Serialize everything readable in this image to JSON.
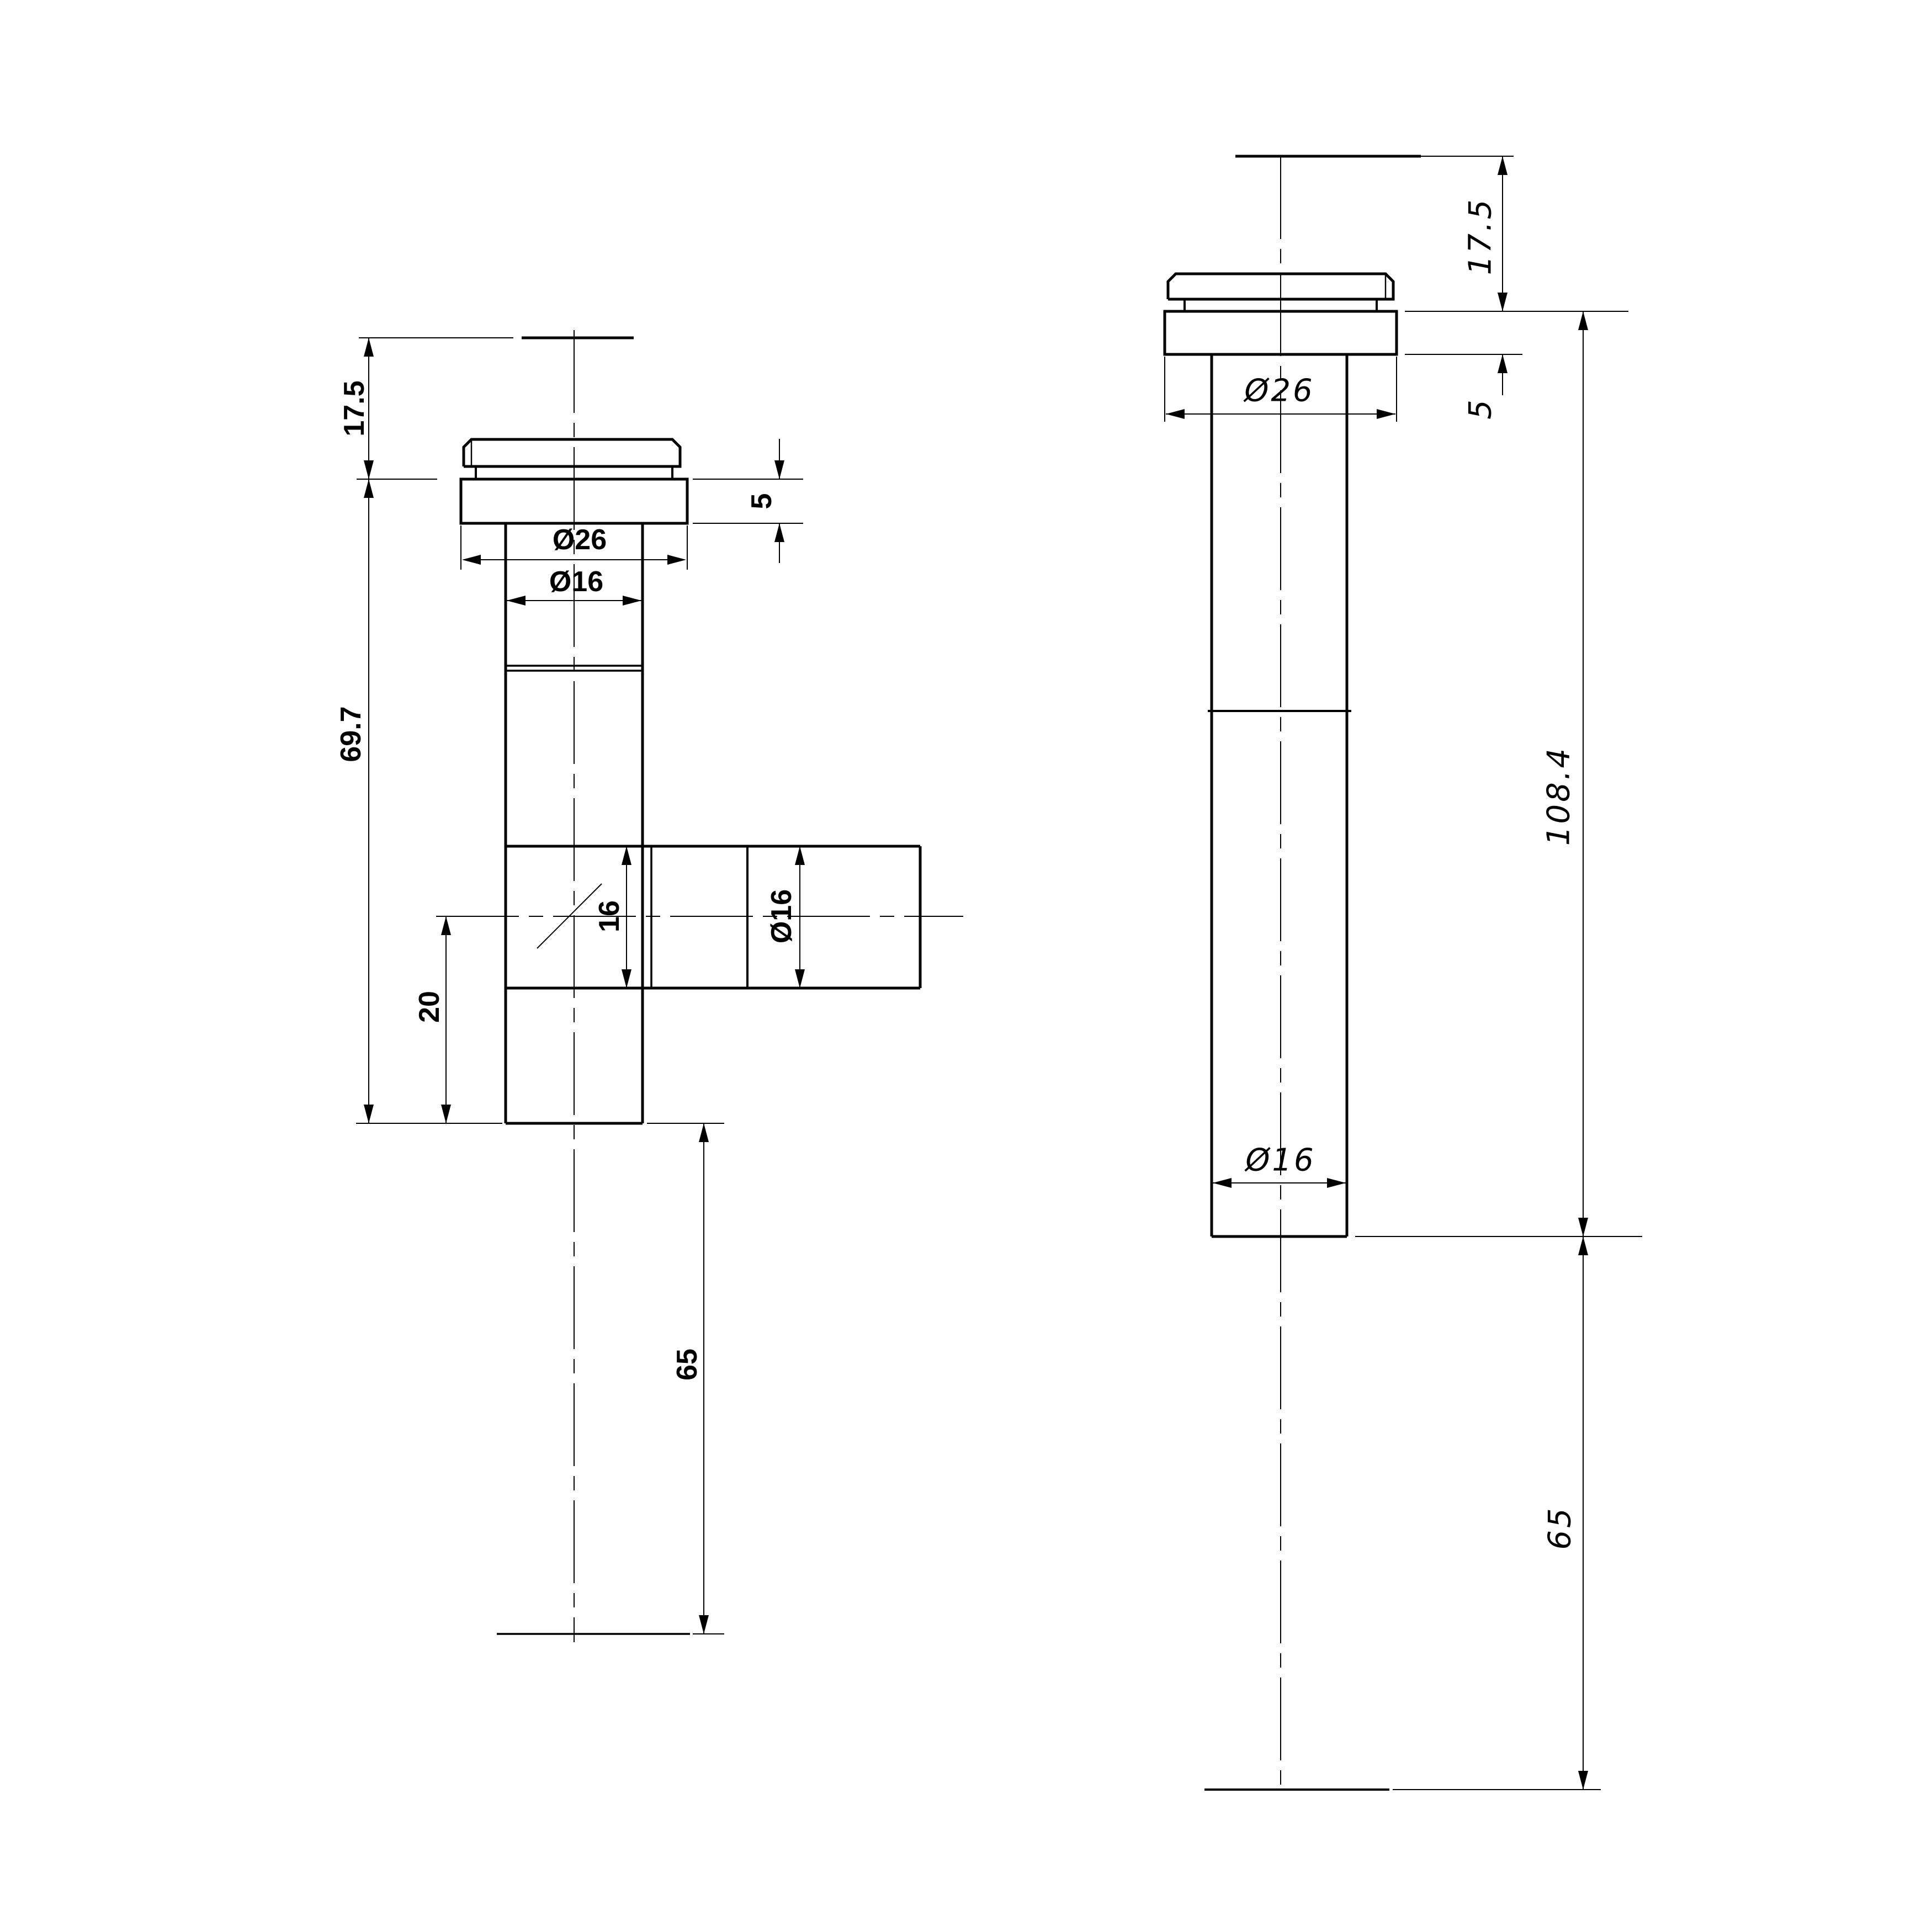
{
  "drawing_type": "2-view dimensioned technical drawing of tee pipe fitting with aerator cap",
  "colors": {
    "ink": "#000000",
    "paper": "#ffffff"
  },
  "front": {
    "d17_5": "17.5",
    "d69_7": "69.7",
    "d5": "5",
    "dia26": "Ø26",
    "dia16_top": "Ø16",
    "d16": "16",
    "dia16_branch": "Ø16",
    "d20": "20",
    "d65": "65"
  },
  "side": {
    "d17_5": "17.5",
    "d5": "5",
    "dia26": "Ø26",
    "d108_4": "108.4",
    "dia16": "Ø16",
    "d65": "65"
  }
}
